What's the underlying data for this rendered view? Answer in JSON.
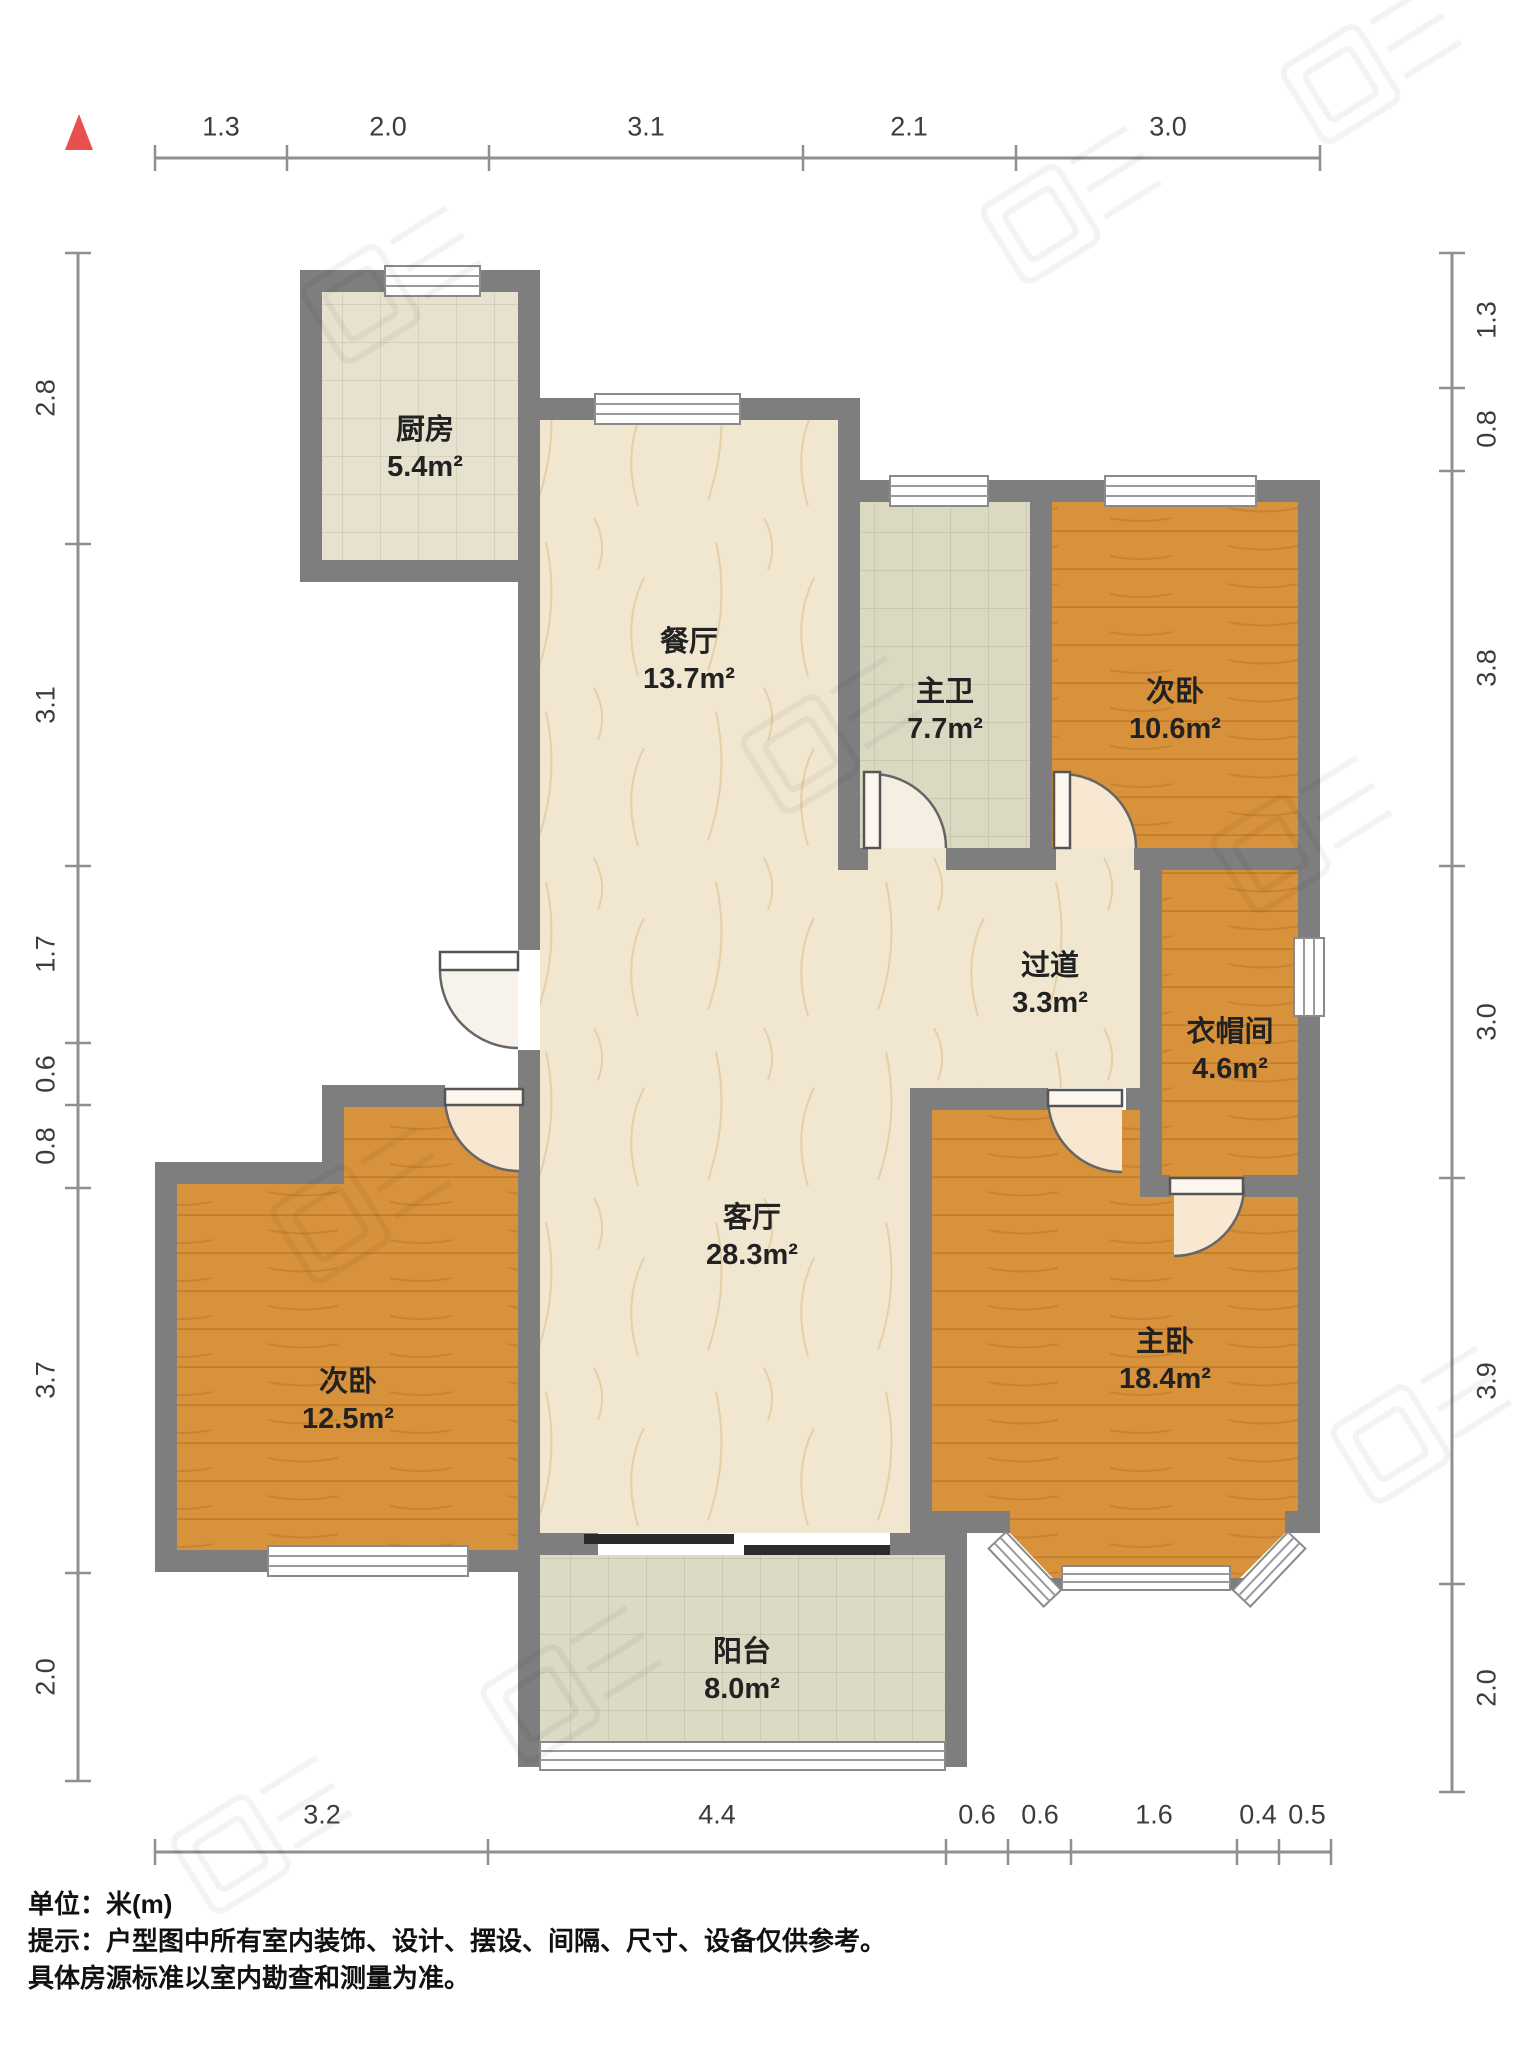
{
  "title": "户型图",
  "unit_scale": "米(m)",
  "north_icon": "north-arrow-icon",
  "rooms": {
    "kitchen": {
      "name": "厨房",
      "area": "5.4m²"
    },
    "dining": {
      "name": "餐厅",
      "area": "13.7m²"
    },
    "master_bath": {
      "name": "主卫",
      "area": "7.7m²"
    },
    "bedroom_top": {
      "name": "次卧",
      "area": "10.6m²"
    },
    "hallway": {
      "name": "过道",
      "area": "3.3m²"
    },
    "cloakroom": {
      "name": "衣帽间",
      "area": "4.6m²"
    },
    "living": {
      "name": "客厅",
      "area": "28.3m²"
    },
    "bedroom_left": {
      "name": "次卧",
      "area": "12.5m²"
    },
    "master_bedroom": {
      "name": "主卧",
      "area": "18.4m²"
    },
    "balcony": {
      "name": "阳台",
      "area": "8.0m²"
    }
  },
  "dimensions": {
    "top": [
      "1.3",
      "2.0",
      "3.1",
      "2.1",
      "3.0"
    ],
    "left": [
      "2.8",
      "3.1",
      "1.7",
      "0.6",
      "0.8",
      "3.7",
      "2.0"
    ],
    "right": [
      "1.3",
      "0.8",
      "3.8",
      "3.0",
      "3.9",
      "2.0"
    ],
    "bottom": [
      "3.2",
      "4.4",
      "0.6",
      "0.6",
      "1.6",
      "0.4",
      "0.5"
    ]
  },
  "footer": {
    "unit_line": "单位：米(m)",
    "tip_line1": "提示：户型图中所有室内装饰、设计、摆设、间隔、尺寸、设备仅供参考。",
    "tip_line2": "具体房源标准以室内勘查和测量为准。"
  },
  "colors": {
    "wall": "#7e7e7e",
    "wood_floor": "#d8923c",
    "marble_floor": "#f1e6d0",
    "tile_floor": "#dcd9c3",
    "kitchen_floor": "#e7e2cf",
    "north_arrow": "#e8514b",
    "dim_text": "#3c3c3c"
  }
}
